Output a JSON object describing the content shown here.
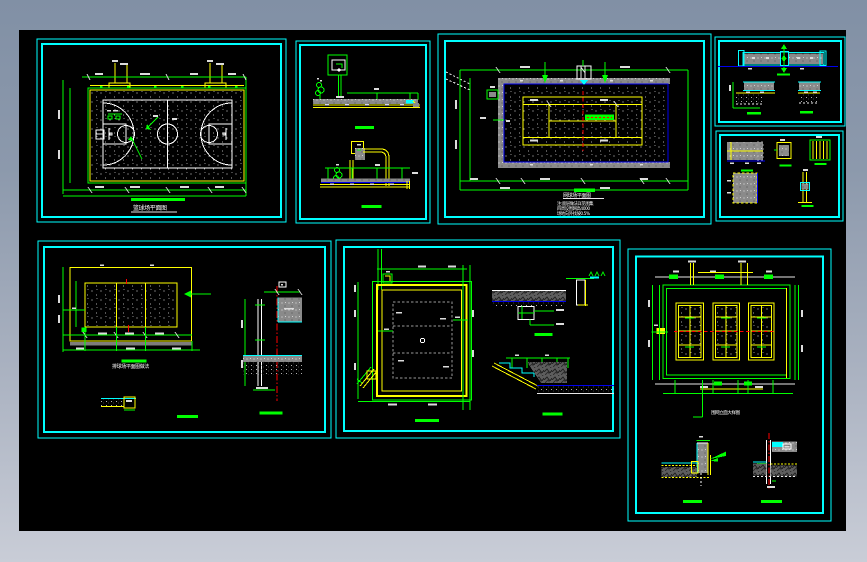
{
  "viewer": {
    "frame_top_color": "#8190a5",
    "frame_bottom_color": "#c9cdd7",
    "canvas_color": "#000000"
  },
  "palette": {
    "panel_border": "#00ffff",
    "dimension_lines": "#00ff00",
    "court_lines": "#ffff00",
    "markings": "#ffffff",
    "axis_centerline": "#ff0000",
    "water_line": "#0000ee",
    "wall_fill": "#8a8a8a"
  },
  "panels": {
    "basketball": {
      "caption": "篮球场平面图"
    },
    "tennis": {
      "caption": "网球场平面图",
      "notes": [
        "注:面层做法详见图集",
        "四周设围网高4000",
        "场地向外找坡0.5%"
      ]
    },
    "volleyball": {
      "caption": "排球场平面图做法"
    },
    "fence": {
      "caption": "围网立面大样图"
    }
  }
}
